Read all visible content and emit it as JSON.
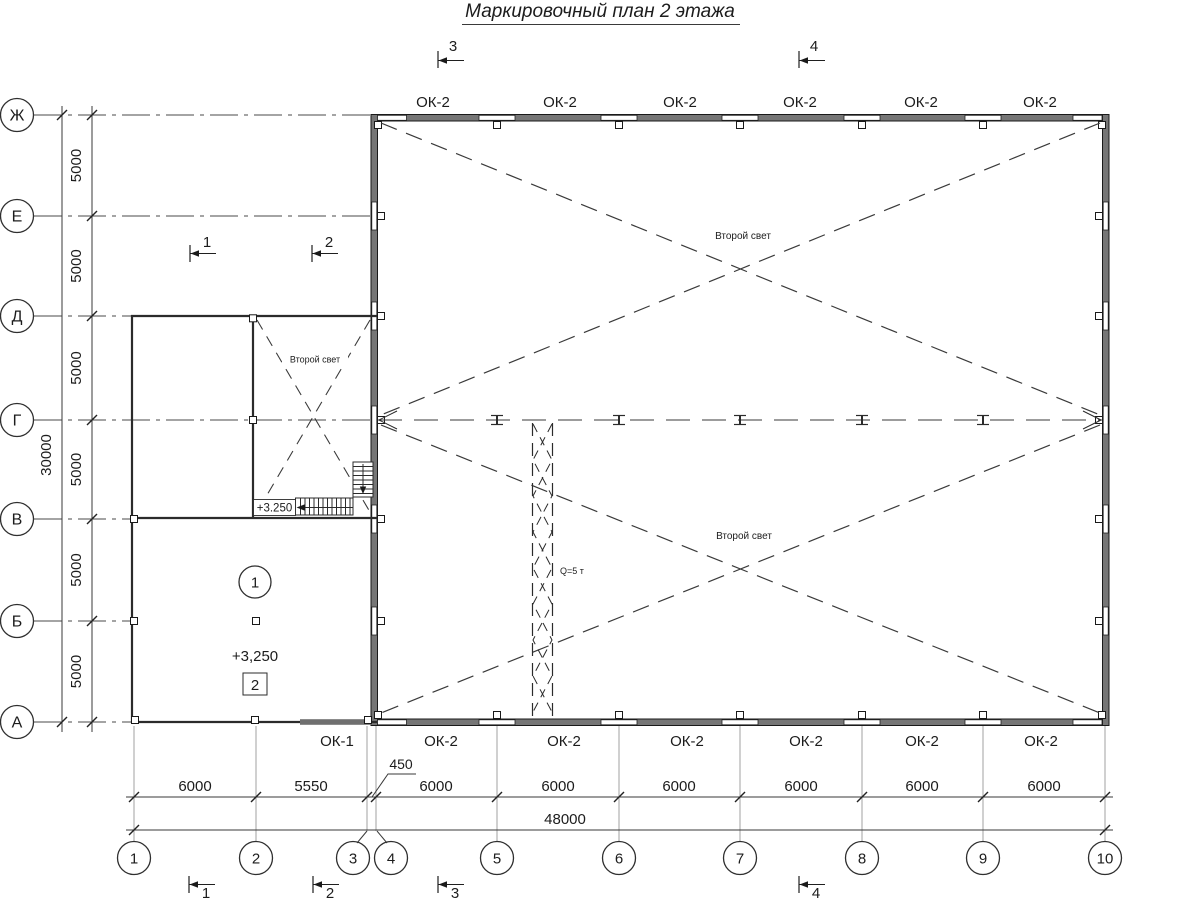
{
  "title": "Маркировочный план 2 этажа",
  "axes": {
    "rows": [
      {
        "label": "Ж"
      },
      {
        "label": "Е"
      },
      {
        "label": "Д"
      },
      {
        "label": "Г"
      },
      {
        "label": "В"
      },
      {
        "label": "Б"
      },
      {
        "label": "А"
      }
    ],
    "cols": [
      {
        "label": "1"
      },
      {
        "label": "2"
      },
      {
        "label": "3"
      },
      {
        "label": "4"
      },
      {
        "label": "5"
      },
      {
        "label": "6"
      },
      {
        "label": "7"
      },
      {
        "label": "8"
      },
      {
        "label": "9"
      },
      {
        "label": "10"
      }
    ]
  },
  "dimensions": {
    "left": {
      "segments": [
        "5000",
        "5000",
        "5000",
        "5000",
        "5000",
        "5000"
      ],
      "total": "30000"
    },
    "bottom": {
      "row1": [
        "6000",
        "5550",
        "450",
        "6000",
        "6000",
        "6000",
        "6000",
        "6000",
        "6000"
      ],
      "total": "48000"
    }
  },
  "windows": {
    "top": [
      "ОК-2",
      "ОК-2",
      "ОК-2",
      "ОК-2",
      "ОК-2",
      "ОК-2"
    ],
    "bottom": [
      "ОК-1",
      "ОК-2",
      "ОК-2",
      "ОК-2",
      "ОК-2",
      "ОК-2",
      "ОК-2"
    ]
  },
  "marks": {
    "second_light": "Второй свет",
    "crane_capacity": "Q=5 т",
    "stair_elevation": "+3.250",
    "floor_elevation": "+3,250",
    "room_number": "1",
    "plan_mark": "2"
  },
  "sections": {
    "top": [
      "3",
      "4"
    ],
    "middle": [
      "1",
      "2"
    ],
    "bottom": [
      "1",
      "2",
      "3",
      "4"
    ]
  }
}
